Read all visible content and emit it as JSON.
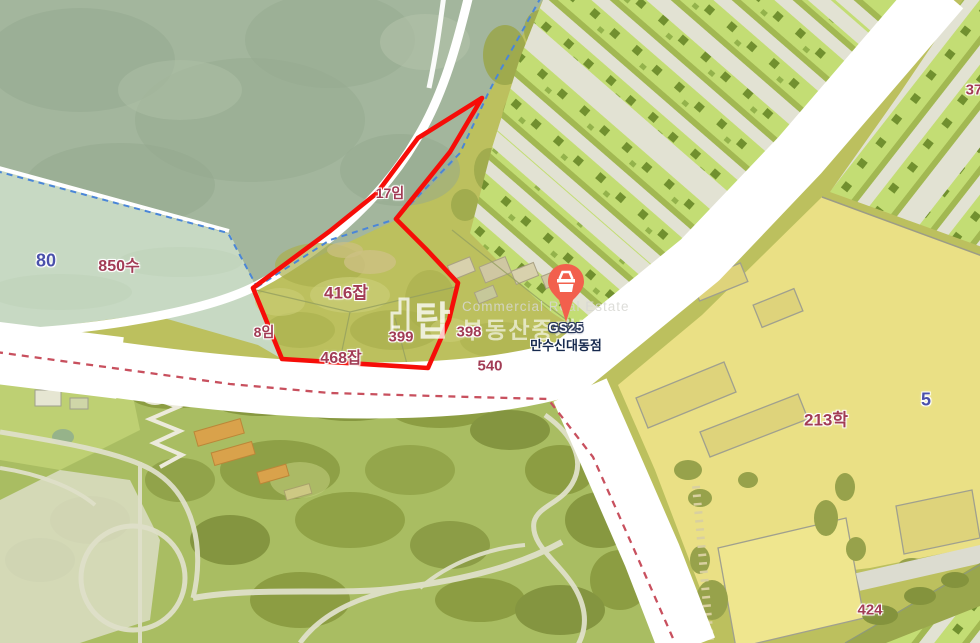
{
  "app": {
    "view": "cadastral-map"
  },
  "colors": {
    "label_maroon": "#a23c55",
    "label_blue": "#4a50ab",
    "highlight_red": "#f60d08",
    "cadastral_dash_blue": "#4a86d8",
    "admin_dash_red": "#c8505e",
    "pin_color": "#f2604d"
  },
  "labels": [
    {
      "text": "80",
      "x": 46,
      "y": 261,
      "style": "blue",
      "size": 18
    },
    {
      "text": "850수",
      "x": 119,
      "y": 264,
      "style": "maroon",
      "size": 16
    },
    {
      "text": "8임",
      "x": 264,
      "y": 332,
      "style": "maroon",
      "size": 14
    },
    {
      "text": "17임",
      "x": 390,
      "y": 193,
      "style": "maroon",
      "size": 14
    },
    {
      "text": "416잡",
      "x": 346,
      "y": 291,
      "style": "maroon",
      "size": 17
    },
    {
      "text": "399",
      "x": 401,
      "y": 337,
      "style": "maroon",
      "size": 15
    },
    {
      "text": "398",
      "x": 469,
      "y": 332,
      "style": "maroon",
      "size": 15
    },
    {
      "text": "468잡",
      "x": 341,
      "y": 356,
      "style": "maroon",
      "size": 16
    },
    {
      "text": "540",
      "x": 490,
      "y": 366,
      "style": "maroon",
      "size": 15
    },
    {
      "text": "213학",
      "x": 826,
      "y": 418,
      "style": "maroon",
      "size": 17
    },
    {
      "text": "5",
      "x": 926,
      "y": 400,
      "style": "blue",
      "size": 18
    },
    {
      "text": "424",
      "x": 870,
      "y": 610,
      "style": "maroon",
      "size": 15
    },
    {
      "text": "37",
      "x": 974,
      "y": 90,
      "style": "maroon",
      "size": 15
    }
  ],
  "marker": {
    "brand": "GS25",
    "name": "만수신대동점",
    "x": 566,
    "y": 262
  },
  "watermark": {
    "logo_char": "탑",
    "line_en": "Commercial Real Estate",
    "line_ko": "부동산중개법인"
  },
  "highlight": {
    "points": "482,98 450,152 396,219 426,249 458,283 449,320 428,368 282,359 253,288 330,231 377,193 418,138"
  }
}
